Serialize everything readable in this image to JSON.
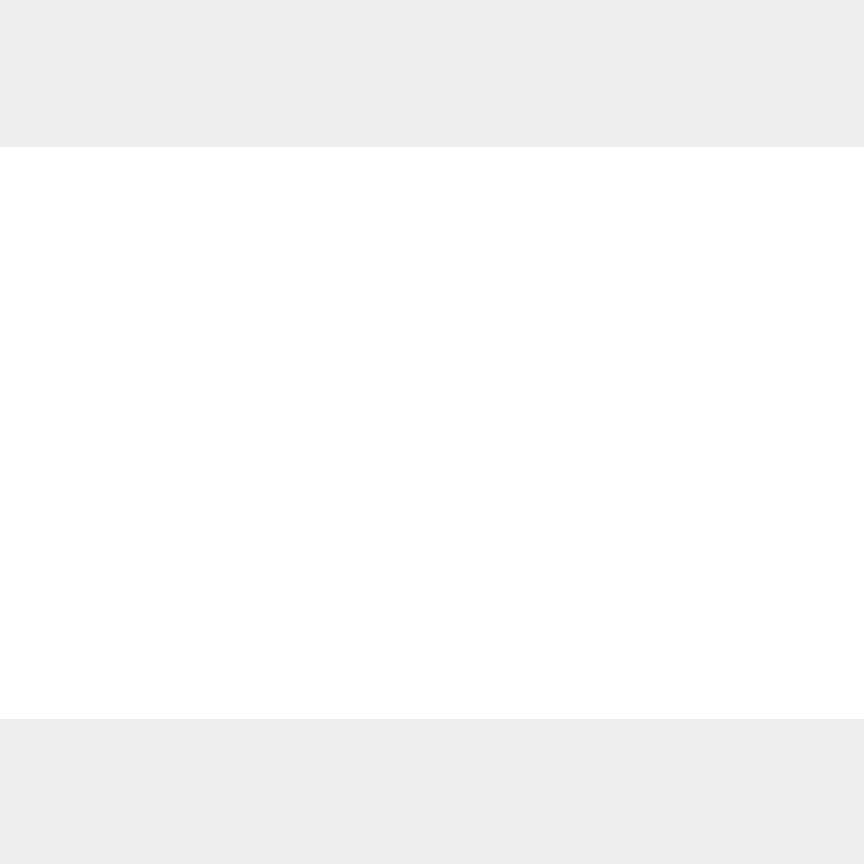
{
  "meta": {
    "kind": "architectural-floor-plan",
    "canvas_w": 864,
    "canvas_h": 864
  },
  "colors": {
    "page_bg": "#ffffff",
    "band_bg": "#eeeeef",
    "wall": "#949494",
    "pillar": "#8a8b8d",
    "thin_line": "#9c9c9c",
    "window_line": "#a5a5a5",
    "car_outline": "#b5b5b5",
    "stair_line": "#8f8f8f",
    "arc_line": "#b0b0b0",
    "dot": "#6f6f6f"
  },
  "background_bands": [
    {
      "x": 0,
      "y": 0,
      "w": 864,
      "h": 147
    },
    {
      "x": 0,
      "y": 719,
      "w": 864,
      "h": 145
    }
  ],
  "windows": [
    [
      8,
      179,
      840,
      9
    ],
    [
      8,
      676,
      832,
      9
    ],
    [
      7,
      328,
      7,
      50
    ],
    [
      7,
      466,
      7,
      59
    ],
    [
      7,
      545,
      7,
      50
    ],
    [
      7,
      615,
      7,
      55
    ],
    [
      18,
      209,
      54,
      6
    ]
  ],
  "walls": [
    [
      8,
      186,
      8,
      142
    ],
    [
      8,
      325,
      96,
      13
    ],
    [
      8,
      378,
      7,
      88
    ],
    [
      8,
      455,
      96,
      11
    ],
    [
      0,
      525,
      12,
      20
    ],
    [
      5,
      670,
      20,
      19
    ],
    [
      72,
      188,
      14,
      30
    ],
    [
      147,
      188,
      8,
      60
    ],
    [
      138,
      244,
      18,
      9
    ],
    [
      85,
      255,
      70,
      8
    ],
    [
      213,
      188,
      9,
      63
    ],
    [
      213,
      248,
      72,
      9
    ],
    [
      277,
      248,
      9,
      24
    ],
    [
      351,
      188,
      9,
      11
    ],
    [
      306,
      260,
      52,
      8
    ],
    [
      306,
      268,
      8,
      17
    ],
    [
      420,
      188,
      13,
      159
    ],
    [
      433,
      275,
      32,
      7
    ],
    [
      459,
      275,
      8,
      44
    ],
    [
      555,
      188,
      11,
      68
    ],
    [
      555,
      253,
      23,
      9
    ],
    [
      625,
      188,
      10,
      159
    ],
    [
      759,
      188,
      18,
      34
    ],
    [
      765,
      222,
      7,
      45
    ],
    [
      714,
      256,
      61,
      9
    ],
    [
      714,
      265,
      9,
      82
    ],
    [
      780,
      254,
      58,
      10
    ],
    [
      806,
      249,
      32,
      20
    ],
    [
      778,
      390,
      60,
      12
    ],
    [
      806,
      386,
      32,
      20
    ],
    [
      808,
      459,
      38,
      11
    ],
    [
      815,
      455,
      25,
      18
    ],
    [
      790,
      598,
      48,
      12
    ],
    [
      804,
      594,
      34,
      20
    ],
    [
      8,
      338,
      47,
      9
    ],
    [
      78,
      338,
      112,
      9
    ],
    [
      214,
      338,
      138,
      9
    ],
    [
      378,
      338,
      94,
      9
    ],
    [
      496,
      338,
      60,
      9
    ],
    [
      580,
      338,
      68,
      9
    ],
    [
      674,
      338,
      108,
      9
    ],
    [
      808,
      338,
      37,
      9
    ],
    [
      9,
      396,
      22,
      7
    ],
    [
      46,
      396,
      24,
      7
    ],
    [
      86,
      396,
      17,
      7
    ],
    [
      49,
      403,
      8,
      44
    ],
    [
      103,
      363,
      72,
      10
    ],
    [
      103,
      373,
      10,
      110
    ],
    [
      165,
      363,
      10,
      80
    ],
    [
      175,
      390,
      115,
      8
    ],
    [
      282,
      390,
      8,
      93
    ],
    [
      100,
      466,
      74,
      8
    ],
    [
      8,
      483,
      282,
      9
    ],
    [
      313,
      378,
      118,
      10
    ],
    [
      313,
      388,
      10,
      99
    ],
    [
      331,
      388,
      10,
      89
    ],
    [
      421,
      378,
      10,
      109
    ],
    [
      313,
      477,
      118,
      10
    ],
    [
      567,
      378,
      132,
      10
    ],
    [
      699,
      368,
      11,
      120
    ],
    [
      567,
      378,
      10,
      26
    ],
    [
      575,
      423,
      9,
      50
    ],
    [
      567,
      473,
      132,
      12
    ],
    [
      709,
      383,
      50,
      9
    ],
    [
      750,
      392,
      9,
      12
    ],
    [
      734,
      425,
      8,
      40
    ],
    [
      734,
      457,
      33,
      8
    ],
    [
      310,
      498,
      123,
      10
    ],
    [
      421,
      508,
      12,
      52
    ],
    [
      340,
      508,
      9,
      125
    ],
    [
      350,
      627,
      52,
      14
    ],
    [
      421,
      633,
      12,
      45
    ],
    [
      433,
      521,
      80,
      8
    ],
    [
      541,
      521,
      35,
      8
    ],
    [
      576,
      522,
      52,
      6
    ],
    [
      660,
      522,
      34,
      6
    ],
    [
      708,
      528,
      11,
      8
    ],
    [
      729,
      508,
      100,
      10
    ],
    [
      756,
      518,
      8,
      20
    ],
    [
      718,
      563,
      58,
      8
    ],
    [
      756,
      571,
      8,
      76
    ],
    [
      750,
      645,
      26,
      17
    ],
    [
      693,
      508,
      12,
      168
    ],
    [
      25,
      510,
      64,
      7
    ],
    [
      77,
      508,
      24,
      14
    ],
    [
      97,
      515,
      8,
      66
    ],
    [
      103,
      539,
      48,
      8
    ],
    [
      97,
      578,
      25,
      8
    ],
    [
      5,
      595,
      33,
      17
    ],
    [
      38,
      598,
      28,
      8
    ],
    [
      77,
      596,
      24,
      14
    ],
    [
      80,
      610,
      8,
      35
    ],
    [
      145,
      512,
      10,
      34
    ],
    [
      145,
      566,
      10,
      110
    ],
    [
      233,
      523,
      9,
      30
    ],
    [
      233,
      578,
      9,
      24
    ],
    [
      233,
      596,
      58,
      9
    ],
    [
      281,
      605,
      9,
      71
    ],
    [
      576,
      560,
      14,
      8
    ],
    [
      608,
      560,
      22,
      8
    ],
    [
      671,
      560,
      23,
      8
    ],
    [
      576,
      585,
      38,
      8
    ],
    [
      629,
      586,
      9,
      90
    ]
  ],
  "pillars_top": {
    "xs": [
      70,
      141,
      208,
      280,
      346,
      423,
      490,
      562,
      633,
      696,
      762
    ],
    "y": 178,
    "w": 20,
    "h": 24,
    "corner_left": [
      6,
      178,
      16,
      40
    ],
    "corner_right": [
      828,
      178,
      22,
      22
    ]
  },
  "pillars_bottom": {
    "xs": [
      70,
      141,
      208,
      278,
      421,
      487,
      557,
      627,
      694,
      762
    ],
    "y": 672,
    "w": 20,
    "h": 19,
    "wide": [
      340,
      670,
      26,
      21
    ],
    "corner_right": [
      826,
      656,
      26,
      20
    ]
  },
  "zigzag": {
    "points": [
      [
        846,
        198
      ],
      [
        861,
        236
      ],
      [
        849,
        250
      ],
      [
        849,
        266
      ],
      [
        861,
        304
      ],
      [
        849,
        320
      ],
      [
        849,
        336
      ],
      [
        861,
        374
      ],
      [
        849,
        390
      ],
      [
        849,
        406
      ],
      [
        861,
        444
      ],
      [
        849,
        460
      ],
      [
        849,
        476
      ],
      [
        861,
        514
      ],
      [
        849,
        530
      ],
      [
        849,
        546
      ],
      [
        861,
        584
      ],
      [
        849,
        600
      ],
      [
        849,
        616
      ],
      [
        861,
        650
      ],
      [
        836,
        674
      ]
    ],
    "pier_centers_y": [
      258,
      328,
      398,
      468,
      538,
      608
    ],
    "pier_inner_x": 838,
    "pier_mid_x": 851,
    "pier_tip_x": 860,
    "pier_half_h": 11
  },
  "shaft_boxes": [
    [
      304,
      324,
      15,
      15
    ],
    [
      384,
      324,
      15,
      15
    ],
    [
      432,
      324,
      15,
      15
    ],
    [
      585,
      324,
      15,
      15
    ],
    [
      697,
      324,
      15,
      15
    ],
    [
      744,
      324,
      15,
      15
    ],
    [
      618,
      528,
      17,
      16
    ],
    [
      155,
      512,
      17,
      26
    ],
    [
      97,
      472,
      10,
      12
    ]
  ],
  "elevator_shafts": [
    [
      363,
      388,
      58,
      89
    ],
    [
      473,
      380,
      74,
      107
    ]
  ],
  "elevator_cars": [
    [
      22,
      408,
      26,
      47
    ],
    [
      65,
      408,
      23,
      33
    ],
    [
      381,
      400,
      34,
      27
    ],
    [
      381,
      437,
      34,
      26
    ],
    [
      487,
      407,
      48,
      30
    ],
    [
      487,
      442,
      48,
      28
    ]
  ],
  "vent_cells": [
    [
      480,
      386,
      28,
      12
    ],
    [
      512,
      387,
      17,
      11
    ]
  ],
  "stairs": [
    {
      "kind": "flight",
      "dir": "v",
      "x": 113,
      "y": 373,
      "w": 52,
      "h": 70,
      "step": 5
    },
    {
      "kind": "stringer",
      "x": 135,
      "y": 372,
      "w": 7,
      "h": 72
    },
    {
      "kind": "flight",
      "dir": "h",
      "x": 190,
      "y": 396,
      "w": 60,
      "h": 26,
      "step": 5
    },
    {
      "kind": "flight",
      "dir": "h",
      "x": 190,
      "y": 441,
      "w": 56,
      "h": 24,
      "step": 5
    },
    {
      "kind": "winder",
      "x": 168,
      "y": 420,
      "w": 20,
      "h": 21
    },
    {
      "kind": "flight",
      "dir": "h",
      "x": 619,
      "y": 400,
      "w": 58,
      "h": 23,
      "step": 5
    },
    {
      "kind": "flight",
      "dir": "h",
      "x": 612,
      "y": 441,
      "w": 64,
      "h": 25,
      "step": 5
    },
    {
      "kind": "winder",
      "x": 677,
      "y": 422,
      "w": 20,
      "h": 20
    }
  ],
  "stair_dots": [
    [
      116,
      378
    ],
    [
      161,
      378
    ],
    [
      116,
      440
    ],
    [
      161,
      440
    ],
    [
      193,
      400
    ],
    [
      246,
      400
    ],
    [
      193,
      461
    ],
    [
      243,
      461
    ],
    [
      622,
      403
    ],
    [
      674,
      403
    ],
    [
      616,
      462
    ],
    [
      672,
      462
    ]
  ],
  "stair_arrows": [
    [
      120,
      436,
      136,
      382
    ],
    [
      243,
      450,
      206,
      400
    ],
    [
      666,
      404,
      630,
      414
    ]
  ],
  "ladder_shaft": {
    "x": 382,
    "y": 516,
    "w": 15,
    "h": 112,
    "rungs": 12
  },
  "door_arcs": [
    {
      "x": 78,
      "y": 347,
      "r": 22,
      "q": "SW"
    },
    {
      "x": 214,
      "y": 347,
      "r": 24,
      "q": "SW"
    },
    {
      "x": 378,
      "y": 347,
      "r": 26,
      "q": "SW"
    },
    {
      "x": 472,
      "y": 347,
      "r": 22,
      "q": "SE"
    },
    {
      "x": 556,
      "y": 347,
      "r": 24,
      "q": "SE"
    },
    {
      "x": 674,
      "y": 347,
      "r": 26,
      "q": "SW"
    },
    {
      "x": 808,
      "y": 347,
      "r": 26,
      "q": "SW"
    },
    {
      "x": 72,
      "y": 218,
      "r": 17,
      "q": "SW"
    },
    {
      "x": 433,
      "y": 378,
      "r": 24,
      "q": "SE"
    },
    {
      "x": 467,
      "y": 487,
      "r": 24,
      "q": "NW"
    },
    {
      "x": 60,
      "y": 492,
      "r": 20,
      "q": "SW"
    },
    {
      "x": 310,
      "y": 508,
      "r": 26,
      "q": "NW"
    },
    {
      "x": 421,
      "y": 631,
      "r": 22,
      "q": "NW"
    },
    {
      "x": 729,
      "y": 508,
      "r": 24,
      "q": "NW"
    },
    {
      "x": 567,
      "y": 403,
      "r": 20,
      "q": "SE"
    },
    {
      "x": 187,
      "y": 483,
      "r": 22,
      "q": "SW"
    },
    {
      "x": 660,
      "y": 522,
      "r": 26,
      "q": "NW"
    },
    {
      "x": 541,
      "y": 521,
      "r": 26,
      "q": "NW"
    }
  ]
}
